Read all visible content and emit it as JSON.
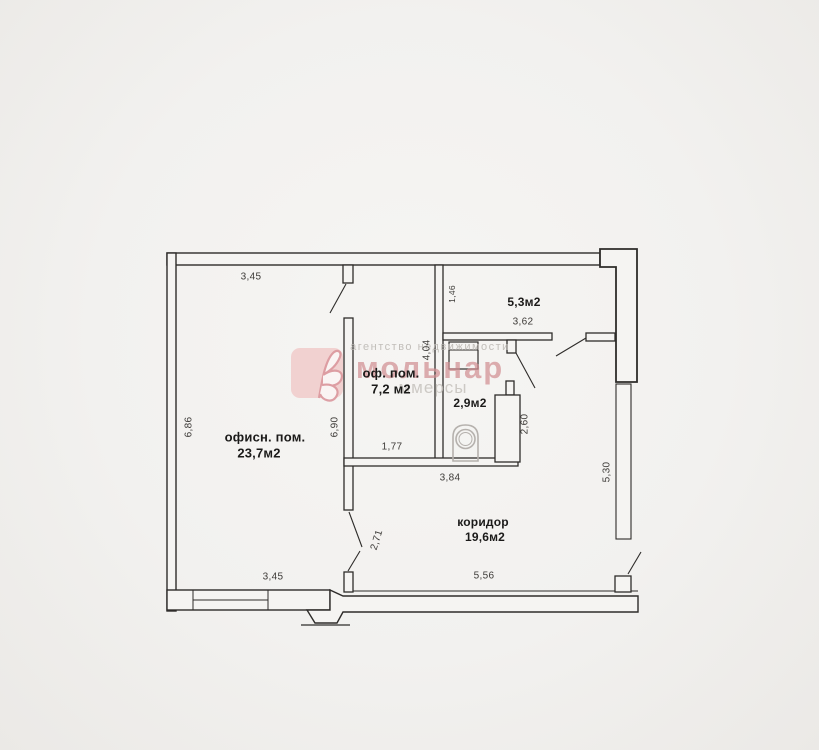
{
  "document": {
    "type": "floor-plan"
  },
  "watermark": {
    "agency_line": "агентство недвижимости",
    "brand": "мольнар",
    "sub_line": "ммерсы"
  },
  "rooms": {
    "office_main": {
      "label": "офисн. пом.",
      "area": "23,7м2"
    },
    "office_small": {
      "label": "оф. пом.",
      "area": "7,2 м2"
    },
    "wc": {
      "area": "2,9м2"
    },
    "room_top_right": {
      "area": "5,3м2"
    },
    "corridor": {
      "label": "коридор",
      "area": "19,6м2"
    }
  },
  "dimensions": {
    "top_width": "3,45",
    "left_height": "6,86",
    "inner_wall_height": "6,90",
    "small_office_width": "1,77",
    "top_right_offset": "1,46",
    "middle_wall_height": "4,04",
    "room_tr_width": "3,62",
    "wc_height": "2,60",
    "corridor_top_width": "3,84",
    "door_opening": "2,71",
    "bottom_left_width": "3,45",
    "corridor_bottom_width": "5,56",
    "right_window_height": "5,30"
  },
  "icons": {
    "toilet": "toilet-icon",
    "sink": "sink-icon",
    "logo": "molnar-leaf-logo-icon"
  },
  "colors": {
    "line": "#2e2c2a",
    "paper": "#f2f1ef",
    "brand_pink": "#d28f93",
    "watermark_gray": "#b9b5b0",
    "fixture_gray": "#b5b1ad"
  }
}
